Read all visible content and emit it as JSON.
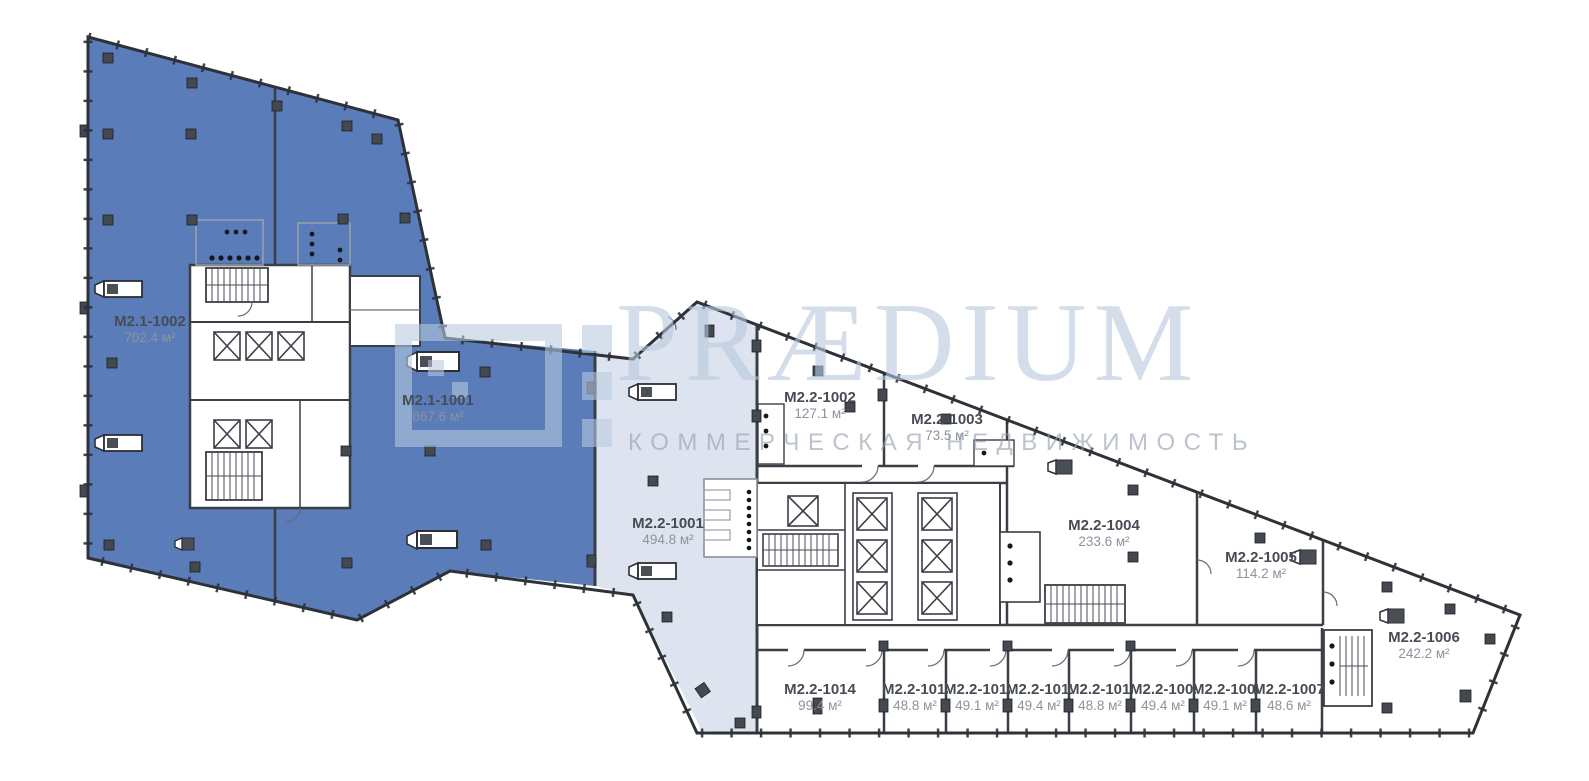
{
  "watermark": {
    "brand": "PRÆDIUM",
    "subtitle": "КОММЕРЧЕСКАЯ НЕДВИЖИМОСТЬ"
  },
  "units": [
    {
      "id": "M2.1-1002",
      "area": "702.4 м²",
      "status": "selected"
    },
    {
      "id": "M2.1-1001",
      "area": "867.6 м²",
      "status": "selected"
    },
    {
      "id": "M2.2-1001",
      "area": "494.8 м²",
      "status": "tinted"
    },
    {
      "id": "M2.2-1002",
      "area": "127.1 м²",
      "status": "available"
    },
    {
      "id": "M2.2-1003",
      "area": "73.5 м²",
      "status": "available"
    },
    {
      "id": "M2.2-1004",
      "area": "233.6 м²",
      "status": "available"
    },
    {
      "id": "M2.2-1005",
      "area": "114.2 м²",
      "status": "available"
    },
    {
      "id": "M2.2-1006",
      "area": "242.2 м²",
      "status": "available"
    },
    {
      "id": "M2.2-1014",
      "area": "99.4 м²",
      "status": "available"
    }
  ],
  "small_units": [
    {
      "id": "M2.2-1013",
      "area": "48.8 м²"
    },
    {
      "id": "M2.2-1012",
      "area": "49.1 м²"
    },
    {
      "id": "M2.2-1011",
      "area": "49.4 м²"
    },
    {
      "id": "M2.2-1010",
      "area": "48.8 м²"
    },
    {
      "id": "M2.2-1009",
      "area": "49.4 м²"
    },
    {
      "id": "M2.2-1008",
      "area": "49.1 м²"
    },
    {
      "id": "M2.2-1007",
      "area": "48.6 м²"
    }
  ],
  "colors": {
    "selected_fill": "#5a7dba",
    "corridor_fill": "#dde4f0",
    "wall": "#3a3e45"
  }
}
